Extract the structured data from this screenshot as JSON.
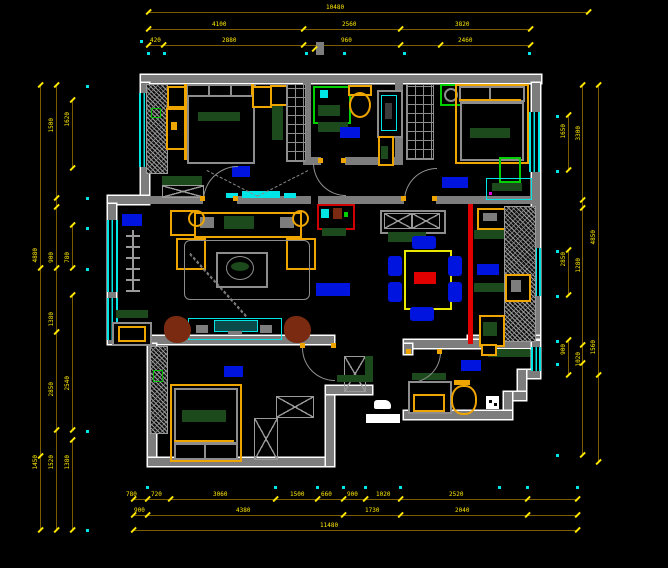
{
  "drawing": {
    "type": "residential-floor-plan",
    "style": "CAD plan view, black background, gray walls, yellow dimension chains"
  },
  "colors": {
    "background": "#000000",
    "wall": "#7d7d7d",
    "wall_outline": "#ffffff",
    "window": "#00e5e5",
    "dimension_line": "#7c5c00",
    "dimension_text": "#ffe800",
    "room_label_marker": "#0014e0",
    "furniture_accent": "#eea500",
    "cushion_green": "#1d4a1d",
    "fixture_green": "#00d000",
    "alert_red": "#e00000",
    "plant_brown": "#7a2a10"
  },
  "dims": {
    "top": {
      "row1": [
        "10480"
      ],
      "row2": [
        "4100",
        "2560",
        "3820"
      ],
      "row3": [
        "420",
        "2880",
        "960",
        "2460"
      ]
    },
    "bottom": {
      "row1": [
        "780",
        "720",
        "3060",
        "1500",
        "660",
        "900",
        "1020",
        "2520"
      ],
      "row2": [
        "900",
        "4380",
        "1730",
        "2040"
      ],
      "row3": [
        "11480"
      ]
    },
    "left": {
      "col1": [
        "4880",
        "1450"
      ],
      "col2": [
        "1500",
        "900",
        "1380",
        "2850",
        "1520"
      ],
      "col3": [
        "1620",
        "780",
        "2540",
        "1380"
      ]
    },
    "right": {
      "col1": [
        "1650",
        "2850",
        "900"
      ],
      "col2": [
        "3300",
        "1280",
        "1020"
      ],
      "col3": [
        "4850",
        "1560"
      ]
    }
  }
}
